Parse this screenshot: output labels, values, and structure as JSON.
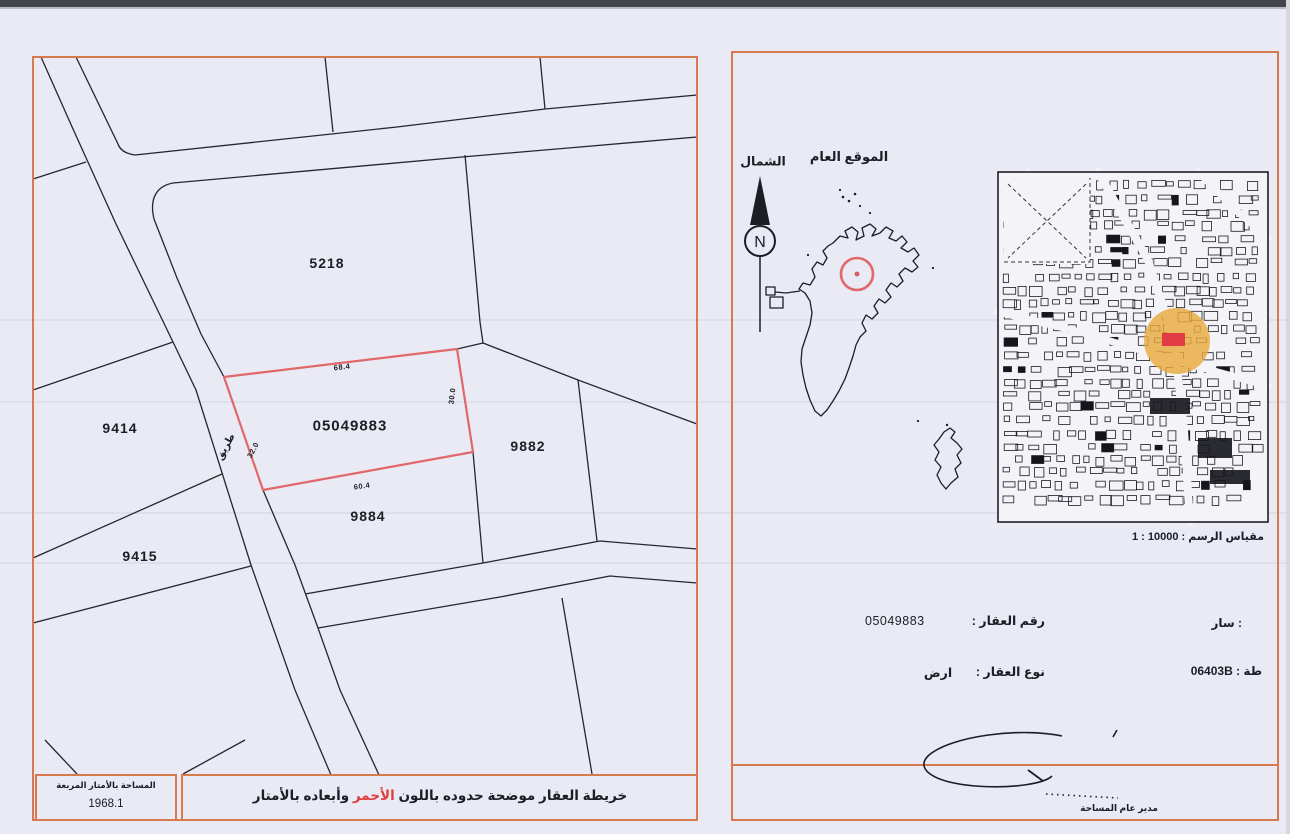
{
  "document_type": "cadastral-survey-map-scan",
  "left_panel": {
    "plots": {
      "main": "05049883",
      "p5218": "5218",
      "p9414": "9414",
      "p9415": "9415",
      "p9884": "9884",
      "p9882": "9882"
    },
    "road_label": "طريق",
    "dimensions": {
      "top": "68.4",
      "right": "30.0",
      "bottom": "60.4",
      "left": "32.0"
    },
    "area_box": {
      "title": "المساحة بالأمتار المربعة",
      "value": "1968.1"
    },
    "caption": {
      "pre": "خريطة العقار موضحة حدوده باللون ",
      "highlight": "الأحمر",
      "post": " وأبعاده بالأمتار"
    }
  },
  "right_panel": {
    "north_label": "الشمال",
    "compass_letter": "N",
    "location_title": "الموقع العام",
    "scale_label": "مقياس الرسم : 10000 : 1",
    "fields": {
      "parcel_number_label": "رقم العقار :",
      "parcel_number": "05049883",
      "parcel_type_label": "نوع العقار :",
      "parcel_type": "ارض",
      "area_name": ": سار",
      "sheet_ref": "طة : 06403B"
    },
    "signature_title": "مدير عام المساحة"
  },
  "colors": {
    "accent_orange": "#d97950",
    "plot_red": "#e0686a",
    "highlight_red": "#e03c3c",
    "circle_yellow": "#e9a93d",
    "marker_red": "#e13c44",
    "line_black": "#26262e"
  }
}
